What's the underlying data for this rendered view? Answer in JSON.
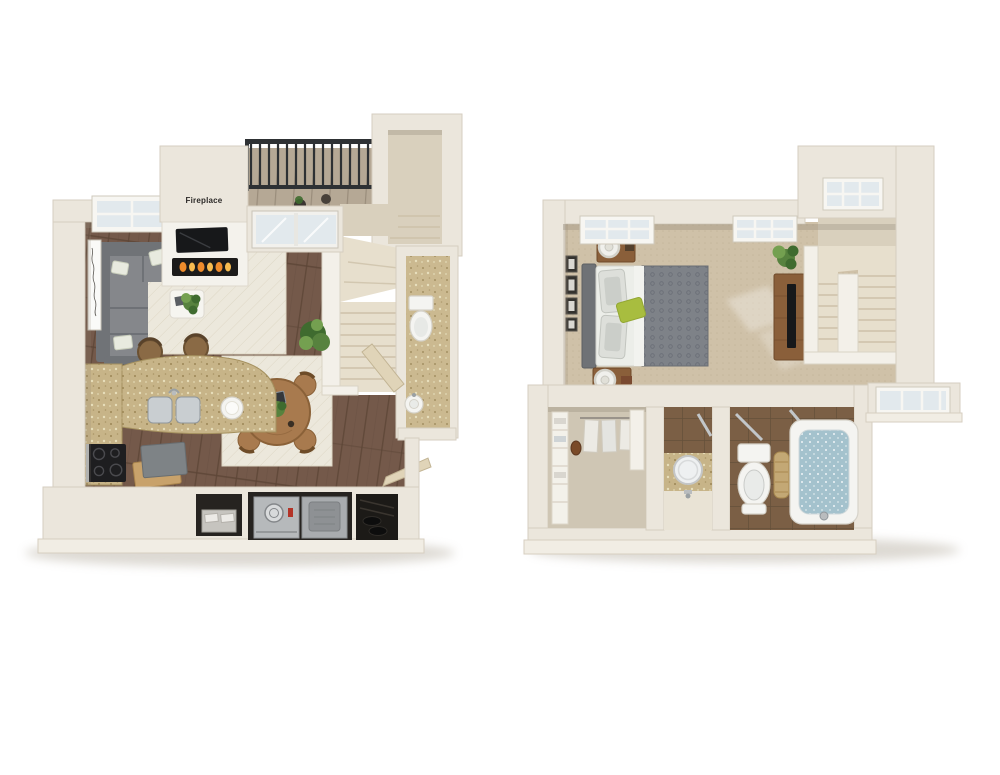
{
  "scene": {
    "type": "3d-floor-plan-rendering",
    "floors_shown": 2
  },
  "labels": {
    "fireplace": "Fireplace"
  },
  "colors": {
    "background": "#ffffff",
    "wall": "#ebe6dc",
    "wall_edge": "#d6cec0",
    "wall_lip": "#f1ede4",
    "white_wall": "#f3f0e9",
    "white_wall_edge": "#dad3c5",
    "hall": "#d9d0bd",
    "shade": "#8f8473",
    "shadow": "#b4ac9e",
    "wood": "#74594a",
    "wood_line": "#5c4536",
    "deck": "#b5a895",
    "deck_line": "#9a8d7b",
    "rug": "#ece8dc",
    "rug_line": "#ded7c5",
    "carpet": "#cfc1a8",
    "carpet_dot": "#c3b49a",
    "granite": "#c7b488",
    "granite_dark": "#9c8656",
    "granite_light": "#e7deba",
    "tile": "#7b5f45",
    "tile_line": "#64503a",
    "water": "#a4c2cd",
    "stair": "#e7dfcd",
    "stair_line": "#cdc1a9",
    "railing": "#2e3134",
    "sofa": "#85878b",
    "sofa_dark": "#707377",
    "sofa_line": "#61646a",
    "headboard": "#6f7276",
    "duvet": "#7e8288",
    "duvet_dot": "#6b6f77",
    "sheet": "#eceee9",
    "pillow_green": "#a8bd3f",
    "wood_furn": "#8a5f3a",
    "wood_furn_dark": "#6f4a2a",
    "wood_table": "#a87a4e",
    "wood_table_dark": "#8a6138",
    "fixture": "#f4f4f1",
    "fixture_edge": "#d5d2c9",
    "metal": "#c9ced1",
    "metal_dark": "#8f969b",
    "plant": "#57823e",
    "plant_light": "#74a050",
    "plant_dark": "#3f6b2f",
    "tv": "#17181a",
    "flame": "#ef8c2c",
    "flame_light": "#f8bc50",
    "box_gray": "#7e8386",
    "box_tan": "#c8a26b",
    "glass": "#e2e9ed",
    "lamp": "#f0f0ec",
    "niche": "#262320",
    "appliance": "#b6b9bb",
    "appliance_dark": "#a9acaf"
  },
  "floor_plans": [
    {
      "id": "first-floor",
      "rooms": [
        "living-room",
        "dining-area",
        "kitchen",
        "half-bathroom",
        "staircase",
        "balcony",
        "entry-hall",
        "laundry-closet",
        "storage-closet"
      ],
      "items": [
        "sectional-sofa",
        "throw-pillows",
        "area-rug",
        "coffee-table",
        "houseplant",
        "side-table",
        "ottoman",
        "wall-art",
        "window",
        "tv",
        "fireplace",
        "sliding-glass-door",
        "balcony-railing",
        "planter-pots",
        "round-dining-table",
        "dining-chairs",
        "dining-rug",
        "kitchen-counter",
        "double-sink",
        "cooktop",
        "bar-stools",
        "serving-plate",
        "storage-boxes",
        "washer",
        "dryer",
        "drawer-cabinet",
        "shoe-shelf",
        "toilet",
        "pedestal-sink",
        "open-doors",
        "stair-landing"
      ]
    },
    {
      "id": "second-floor",
      "rooms": [
        "bedroom",
        "walk-in-closet",
        "vanity-area",
        "bathroom",
        "staircase",
        "stair-hall"
      ],
      "items": [
        "bed",
        "headboard",
        "pillows",
        "accent-pillow",
        "duvet",
        "nightstands",
        "table-lamps",
        "wall-art-frames",
        "windows",
        "media-console",
        "tv",
        "houseplant",
        "sunlight-patches",
        "closet-shelving",
        "hanging-clothes",
        "round-mirror",
        "vanity-sink",
        "towel-bars",
        "toilet",
        "bathtub",
        "laundry-hamper",
        "stair-landing"
      ]
    }
  ]
}
